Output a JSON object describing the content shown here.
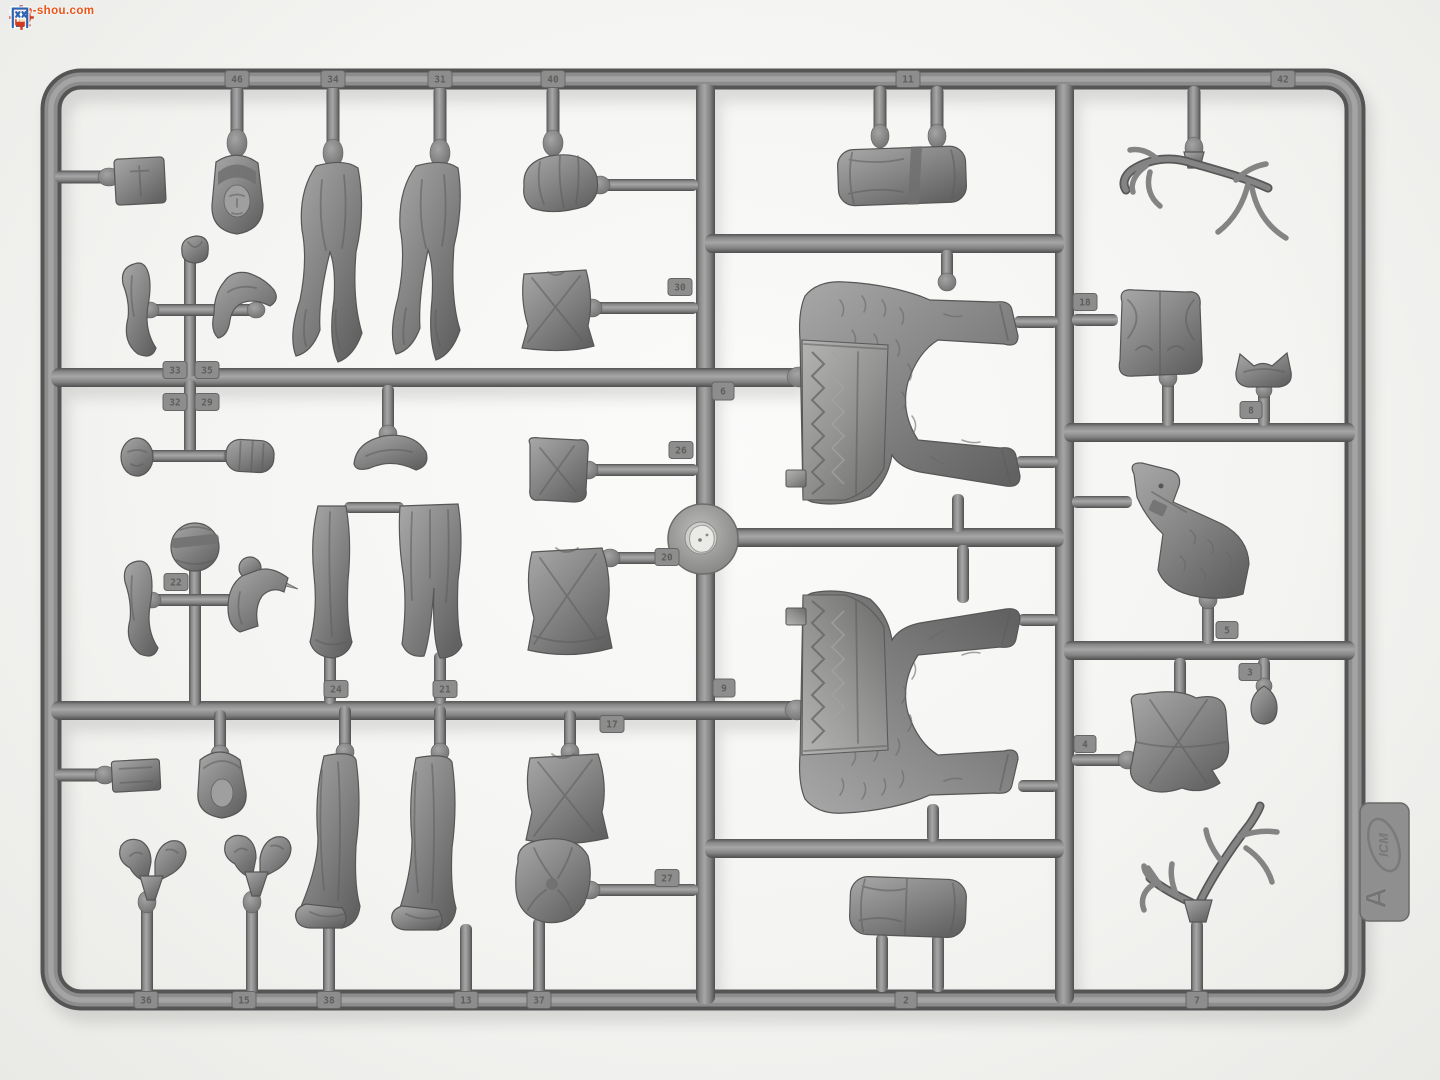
{
  "watermark": {
    "site_cn_left": "高",
    "site_cn_right": "网",
    "icon": "gear-thumbsup-icon",
    "domain": "gao-shou.com",
    "blue": "#2b64b3",
    "red": "#d23a20",
    "orange": "#e85316"
  },
  "sprue": {
    "brand": "ICM",
    "letter": "A",
    "plastic_gray": "#8a8a8a",
    "background_gray": "#f3f3f1",
    "tabs": [
      {
        "n": "46"
      },
      {
        "n": "34"
      },
      {
        "n": "31"
      },
      {
        "n": "40"
      },
      {
        "n": "11"
      },
      {
        "n": "42"
      },
      {
        "n": "33"
      },
      {
        "n": "35"
      },
      {
        "n": "32"
      },
      {
        "n": "29"
      },
      {
        "n": "30"
      },
      {
        "n": "26"
      },
      {
        "n": "6"
      },
      {
        "n": "9"
      },
      {
        "n": "22"
      },
      {
        "n": "24"
      },
      {
        "n": "21"
      },
      {
        "n": "20"
      },
      {
        "n": "17"
      },
      {
        "n": "27"
      },
      {
        "n": "36"
      },
      {
        "n": "15"
      },
      {
        "n": "38"
      },
      {
        "n": "13"
      },
      {
        "n": "37"
      },
      {
        "n": "2"
      },
      {
        "n": "7"
      },
      {
        "n": "18"
      },
      {
        "n": "8"
      },
      {
        "n": "5"
      },
      {
        "n": "3"
      },
      {
        "n": "4"
      }
    ]
  }
}
